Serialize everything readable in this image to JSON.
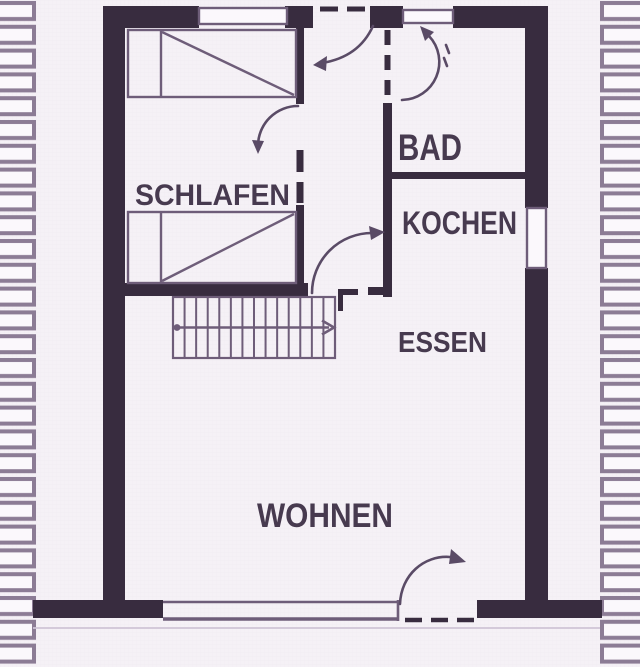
{
  "diagram": {
    "type": "floor-plan",
    "language": "de",
    "rooms": [
      {
        "id": "schlafen",
        "label": "SCHLAFEN"
      },
      {
        "id": "bad",
        "label": "BAD"
      },
      {
        "id": "kochen",
        "label": "KOCHEN"
      },
      {
        "id": "essen",
        "label": "ESSEN"
      },
      {
        "id": "wohnen",
        "label": "WOHNEN"
      }
    ]
  },
  "symbols": {
    "beds": 2,
    "stairs_treads": 13,
    "stairs_direction": "right",
    "door_swings": 5,
    "windows": 4,
    "wall_hatching_strips": 2
  },
  "colors": {
    "paper": "#f5f1f6",
    "wall": "#382c3f",
    "line": "#6e5d79",
    "door": "#5a4b66",
    "hatch": "#8c7c95",
    "hatch_fill": "#fbf8fc",
    "text": "#473a4f",
    "grid": "#ece6f0",
    "faint": "#cfc4d6"
  }
}
